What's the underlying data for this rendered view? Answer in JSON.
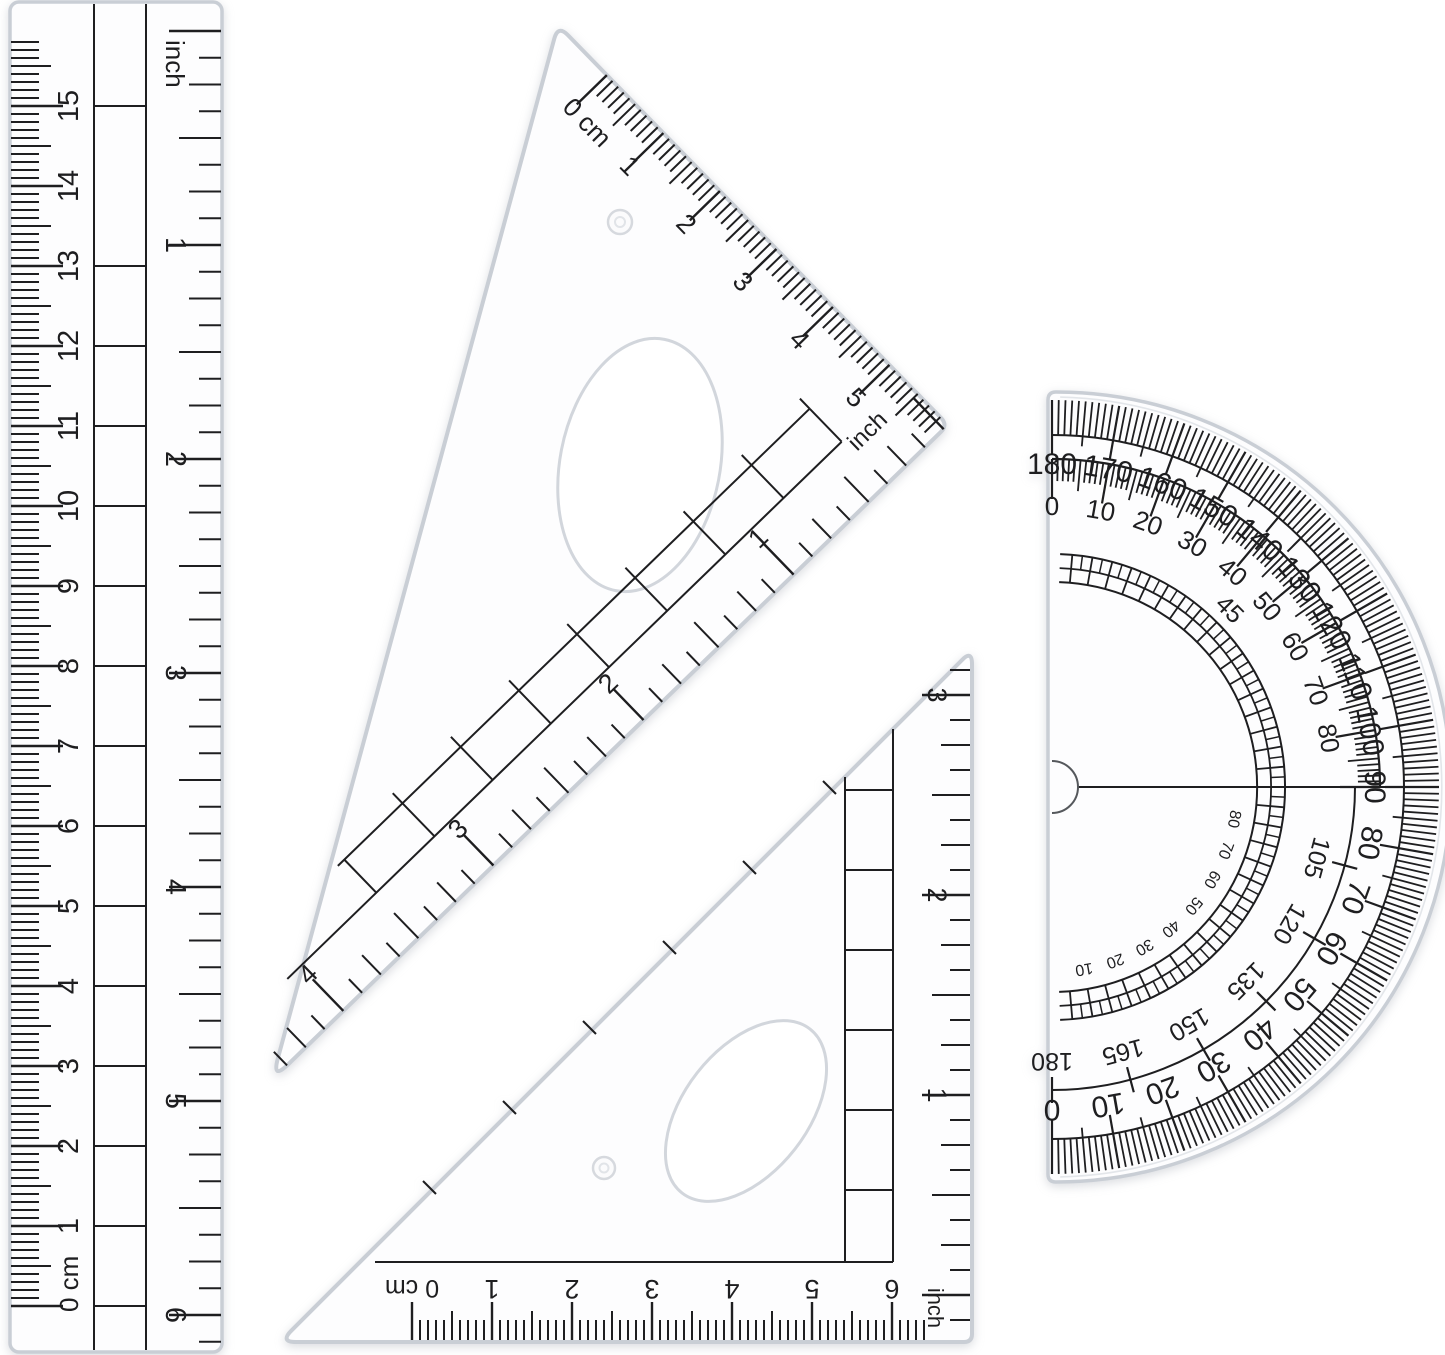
{
  "background": "#ffffff",
  "ink": "#1e1e20",
  "plastic_edge": "#c9ced5",
  "plastic_edge_light": "#e3e6ea",
  "plastic_fill": "#fdfdfe",
  "ruler": {
    "zero_label": "0 cm",
    "cm_numbers": [
      "1",
      "2",
      "3",
      "4",
      "5",
      "6",
      "7",
      "8",
      "9",
      "10",
      "11",
      "12",
      "13",
      "14",
      "15"
    ],
    "inch_label": "inch",
    "inch_numbers": [
      "1",
      "2",
      "3",
      "4",
      "5",
      "6"
    ]
  },
  "large_triangle": {
    "zero_label": "0 cm",
    "cm_numbers": [
      "1",
      "2",
      "3",
      "4",
      "5"
    ],
    "inch_label": "inch",
    "inch_numbers": [
      "1",
      "2",
      "3",
      "4"
    ]
  },
  "small_triangle": {
    "zero_label": "0 cm",
    "cm_numbers": [
      "1",
      "2",
      "3",
      "4",
      "5",
      "6"
    ],
    "inch_label": "inch",
    "inch_numbers": [
      "1",
      "2",
      "3"
    ]
  },
  "protractor": {
    "outer_labels": [
      "180",
      "170",
      "160",
      "150",
      "140",
      "130",
      "120",
      "110",
      "100",
      "90",
      "80",
      "70",
      "60",
      "50",
      "40",
      "30",
      "20",
      "10",
      "0"
    ],
    "inner_top_labels": [
      "0",
      "10",
      "20",
      "30",
      "40",
      "50",
      "60",
      "70",
      "80"
    ],
    "inner_bottom_labels": [
      "105",
      "120",
      "135",
      "150",
      "165",
      "180"
    ],
    "diagonal_label": "45",
    "innermost_labels": [
      "10",
      "20",
      "30",
      "40",
      "50",
      "60",
      "70",
      "80"
    ]
  }
}
